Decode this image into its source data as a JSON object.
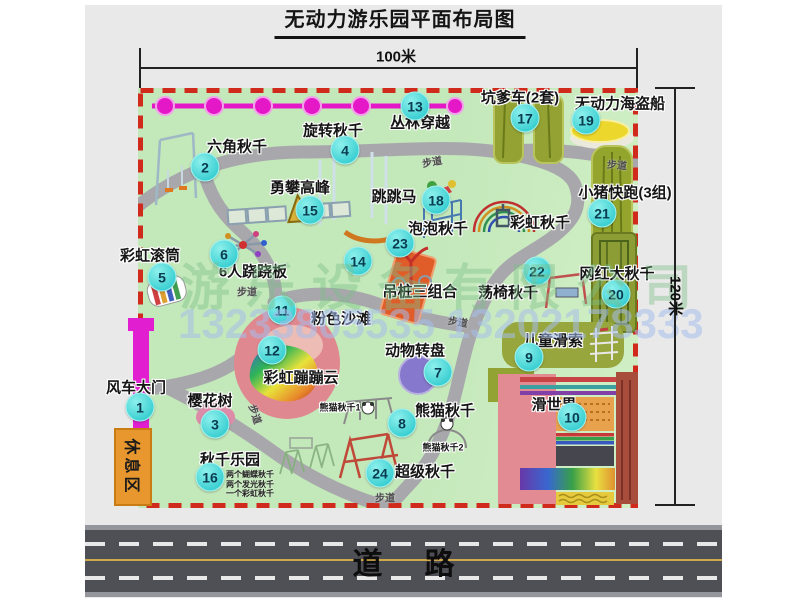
{
  "title": "无动力游乐园平面布局图",
  "dimensions": {
    "width": "100米",
    "height": "120米"
  },
  "road": {
    "label": "道路"
  },
  "watermark": {
    "company": "游乐设备有限公司",
    "phone": "13233805535 13202178333"
  },
  "rest_area": "休息区",
  "path_label_text": "步道",
  "attractions": [
    {
      "num": "1",
      "name": "风车大门",
      "badge": {
        "x": 140,
        "y": 407
      },
      "label": {
        "x": 136,
        "y": 387
      }
    },
    {
      "num": "2",
      "name": "六角秋千",
      "badge": {
        "x": 205,
        "y": 167
      },
      "label": {
        "x": 237,
        "y": 146
      }
    },
    {
      "num": "3",
      "name": "樱花树",
      "badge": {
        "x": 215,
        "y": 424
      },
      "label": {
        "x": 210,
        "y": 400
      }
    },
    {
      "num": "4",
      "name": "旋转秋千",
      "badge": {
        "x": 345,
        "y": 150
      },
      "label": {
        "x": 333,
        "y": 130
      }
    },
    {
      "num": "5",
      "name": "彩虹滚筒",
      "badge": {
        "x": 162,
        "y": 277
      },
      "label": {
        "x": 150,
        "y": 255
      }
    },
    {
      "num": "6",
      "name": "6人跷跷板",
      "badge": {
        "x": 224,
        "y": 254
      },
      "label": {
        "x": 253,
        "y": 271
      }
    },
    {
      "num": "7",
      "name": "动物转盘",
      "badge": {
        "x": 438,
        "y": 372
      },
      "label": {
        "x": 415,
        "y": 350
      }
    },
    {
      "num": "8",
      "name": "熊猫秋千",
      "badge": {
        "x": 402,
        "y": 423
      },
      "label": {
        "x": 445,
        "y": 410
      }
    },
    {
      "num": "9",
      "name": "儿童滑索",
      "badge": {
        "x": 529,
        "y": 357
      },
      "label": {
        "x": 553,
        "y": 340
      }
    },
    {
      "num": "10",
      "name": "滑世界",
      "badge": {
        "x": 572,
        "y": 417
      },
      "label": {
        "x": 554,
        "y": 404
      }
    },
    {
      "num": "11",
      "name": "粉色沙滩",
      "badge": {
        "x": 282,
        "y": 310
      },
      "label": {
        "x": 341,
        "y": 318
      }
    },
    {
      "num": "12",
      "name": "彩虹蹦蹦云",
      "badge": {
        "x": 272,
        "y": 350
      },
      "label": {
        "x": 301,
        "y": 377
      }
    },
    {
      "num": "13",
      "name": "丛林穿越",
      "badge": {
        "x": 415,
        "y": 106
      },
      "label": {
        "x": 420,
        "y": 122
      }
    },
    {
      "num": "14",
      "name": "吊桩三组合",
      "badge": {
        "x": 358,
        "y": 261
      },
      "label": {
        "x": 420,
        "y": 291
      }
    },
    {
      "num": "15",
      "name": "勇攀高峰",
      "badge": {
        "x": 310,
        "y": 210
      },
      "label": {
        "x": 300,
        "y": 187
      }
    },
    {
      "num": "16",
      "name": "秋千乐园",
      "badge": {
        "x": 210,
        "y": 477
      },
      "label": {
        "x": 230,
        "y": 459
      }
    },
    {
      "num": "17",
      "name": "坑爹车(2套)",
      "badge": {
        "x": 525,
        "y": 118
      },
      "label": {
        "x": 520,
        "y": 97
      }
    },
    {
      "num": "18",
      "name": "跳跳马",
      "badge": {
        "x": 436,
        "y": 200
      },
      "label": {
        "x": 394,
        "y": 196
      }
    },
    {
      "num": "19",
      "name": "无动力海盗船",
      "badge": {
        "x": 586,
        "y": 120
      },
      "label": {
        "x": 620,
        "y": 103
      }
    },
    {
      "num": "20",
      "name": "网红大秋千",
      "badge": {
        "x": 616,
        "y": 294
      },
      "label": {
        "x": 617,
        "y": 273
      }
    },
    {
      "num": "21",
      "name": "小猪快跑(3组)",
      "badge": {
        "x": 602,
        "y": 213
      },
      "label": {
        "x": 625,
        "y": 192
      }
    },
    {
      "num": "22",
      "name": "荡椅秋千",
      "badge": {
        "x": 537,
        "y": 271
      },
      "label": {
        "x": 508,
        "y": 292
      }
    },
    {
      "num": "23",
      "name": "泡泡秋千",
      "badge": {
        "x": 400,
        "y": 243
      },
      "label": {
        "x": 438,
        "y": 228
      }
    },
    {
      "num": "24",
      "name": "超级秋千",
      "badge": {
        "x": 380,
        "y": 473
      },
      "label": {
        "x": 425,
        "y": 471
      }
    }
  ],
  "extra_labels": [
    {
      "text": "彩虹秋千",
      "x": 540,
      "y": 222,
      "size": 15
    },
    {
      "text": "熊猫秋千1",
      "x": 340,
      "y": 407,
      "size": 9
    },
    {
      "text": "熊猫秋千2",
      "x": 443,
      "y": 447,
      "size": 9
    }
  ],
  "swing_park_notes": {
    "x": 226,
    "y": 469,
    "dy": 9.5,
    "lines": [
      "两个蝴蝶秋千",
      "两个发光秋千",
      "一个彩虹秋千"
    ]
  },
  "path_labels": [
    {
      "x": 432,
      "y": 161,
      "r": -10
    },
    {
      "x": 617,
      "y": 164,
      "r": 5
    },
    {
      "x": 247,
      "y": 291,
      "r": 0
    },
    {
      "x": 458,
      "y": 321,
      "r": 10
    },
    {
      "x": 256,
      "y": 414,
      "r": 72
    },
    {
      "x": 385,
      "y": 497,
      "r": 0
    }
  ]
}
